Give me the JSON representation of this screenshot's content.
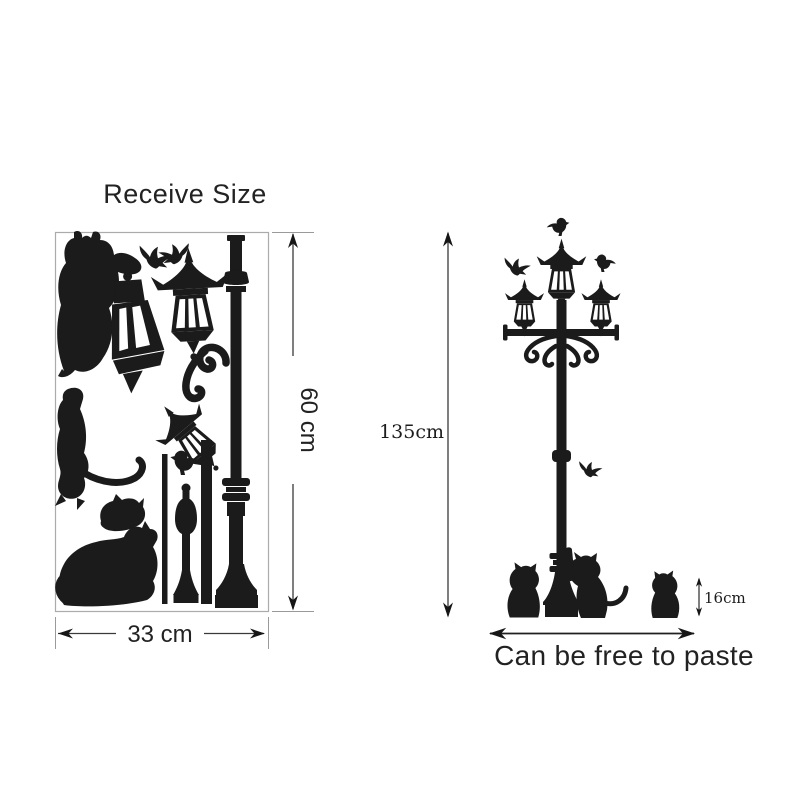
{
  "page": {
    "background": "#ffffff"
  },
  "product_sheet": {
    "title": "Receive Size",
    "width_label": "33 cm",
    "height_label": "60 cm",
    "silhouette_icons": [
      "cat-silhouette",
      "bird-silhouette",
      "street-lantern-silhouette",
      "scroll-ornament-silhouette",
      "rod-silhouette",
      "baluster-silhouette",
      "lamp-post-silhouette"
    ]
  },
  "assembled_view": {
    "total_height_label": "135cm",
    "cat_height_label": "16cm",
    "caption": "Can be free to paste",
    "silhouette_icons": [
      "triple-head-street-lamp",
      "bird-silhouette",
      "cat-silhouette"
    ]
  },
  "colors": {
    "silhouette_ink": "#1b1b1b",
    "dimension_line": "#3a3a3a",
    "sheet_border": "#ababab",
    "background": "#ffffff"
  }
}
